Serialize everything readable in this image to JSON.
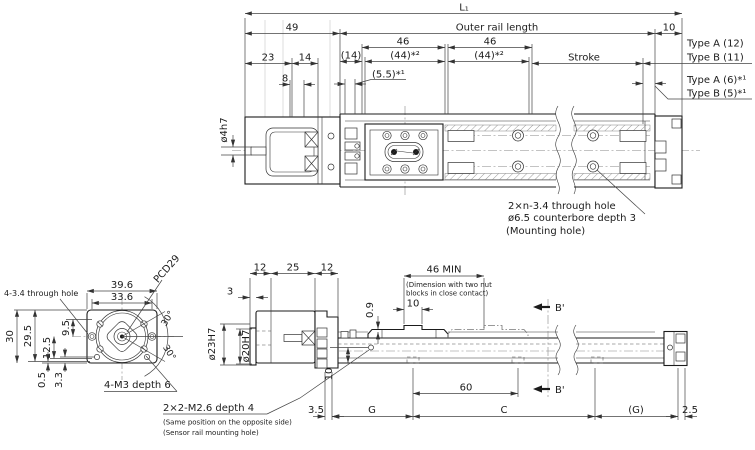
{
  "colors": {
    "line": "#1b1b1b",
    "dim": "#444444",
    "background": "#ffffff"
  },
  "top_view": {
    "l1": "L₁",
    "d49": "49",
    "outer_rail_length": "Outer rail length",
    "d10": "10",
    "d46a": "46",
    "d46b": "46",
    "d44a": "(44)*²",
    "d44b": "(44)*²",
    "d14p": "(14)",
    "d55": "(5.5)*¹",
    "d23": "23",
    "d14": "14",
    "d8": "8",
    "stroke": "Stroke",
    "type_a12": "Type A (12)",
    "type_b11": "Type B (11)",
    "type_a6": "Type A (6)*¹",
    "type_b5": "Type B (5)*¹",
    "phi4h7": "ø4h7",
    "mount_note1": "2×n-3.4 through hole",
    "mount_note2": "ø6.5 counterbore depth 3",
    "mount_note3": "(Mounting hole)"
  },
  "front_view": {
    "d39_6": "39.6",
    "d33_6": "33.6",
    "pcd29": "PCD29",
    "through_hole": "4-3.4 through hole",
    "d30": "30",
    "d29_5": "29.5",
    "d9_5": "9.5",
    "d12_5": "12.5",
    "d0_5": "0.5",
    "d3_3": "3.3",
    "m3": "4-M3 depth 6",
    "angle30a": "30°",
    "angle30b": "30°"
  },
  "side_view": {
    "d12a": "12",
    "d25": "25",
    "d12b": "12",
    "d3": "3",
    "d46min": "46 MIN",
    "note_line1": "(Dimension with two nut",
    "note_line2": "blocks in close contact)",
    "d10top": "10",
    "d0_9": "0.9",
    "phi23h7": "ø23H7",
    "phi20h7": "ø20H7",
    "d10left": "10",
    "d60": "60",
    "b_prime1": "B'",
    "b_prime2": "B'",
    "d3_5": "3.5",
    "g1": "G",
    "c": "C",
    "g2": "(G)",
    "d2_5": "2.5",
    "m26": "2×2-M2.6 depth 4",
    "m26_note1": "(Same position on the opposite side)",
    "m26_note2": "(Sensor rail mounting hole)"
  }
}
